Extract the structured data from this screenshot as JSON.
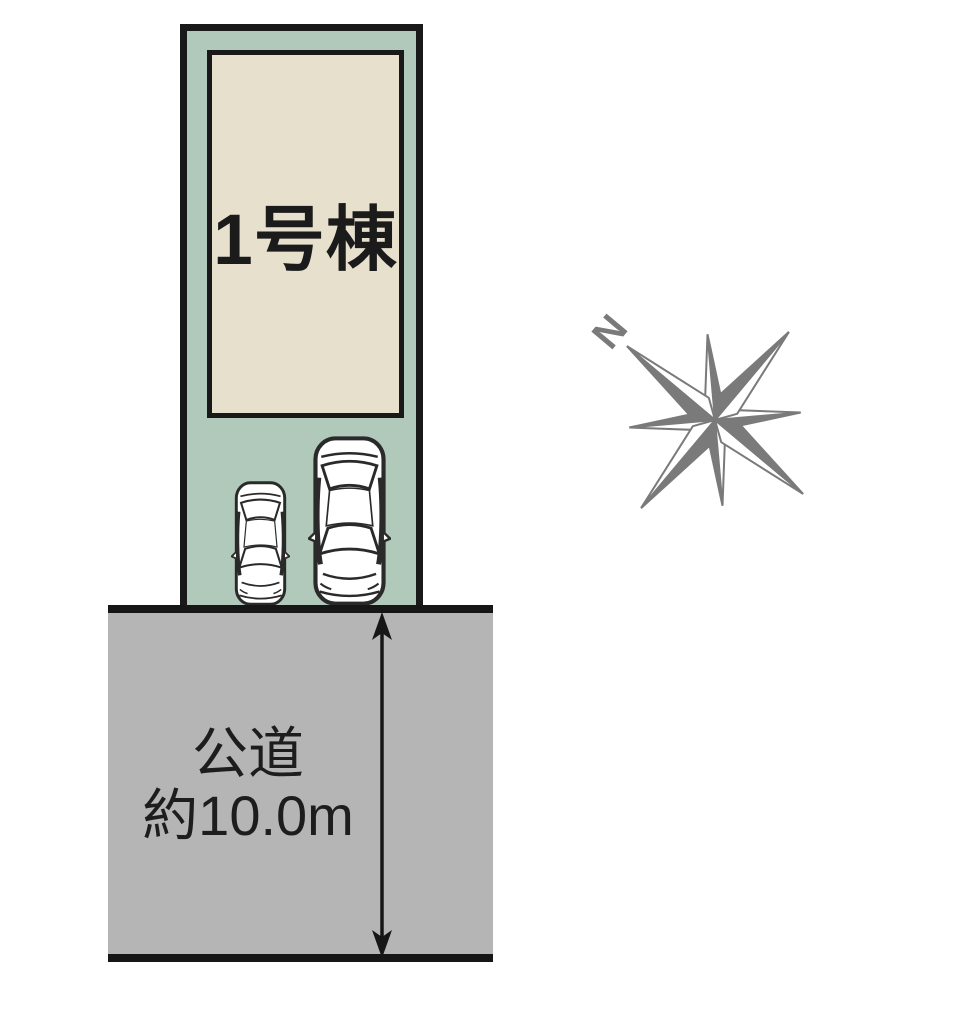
{
  "lot": {
    "building_label": "1号棟",
    "lot_fill": "#b0c9bb",
    "building_fill": "#e7e0cd",
    "outline_color": "#191919"
  },
  "road": {
    "name": "公道",
    "width_text": "約10.0m",
    "fill": "#b5b5b5",
    "text_color": "#1d1d1d"
  },
  "compass": {
    "north_label": "N",
    "color": "#7a7a7a"
  },
  "cars": {
    "body_fill": "#ffffff",
    "outline_color": "#2a2a2a"
  }
}
